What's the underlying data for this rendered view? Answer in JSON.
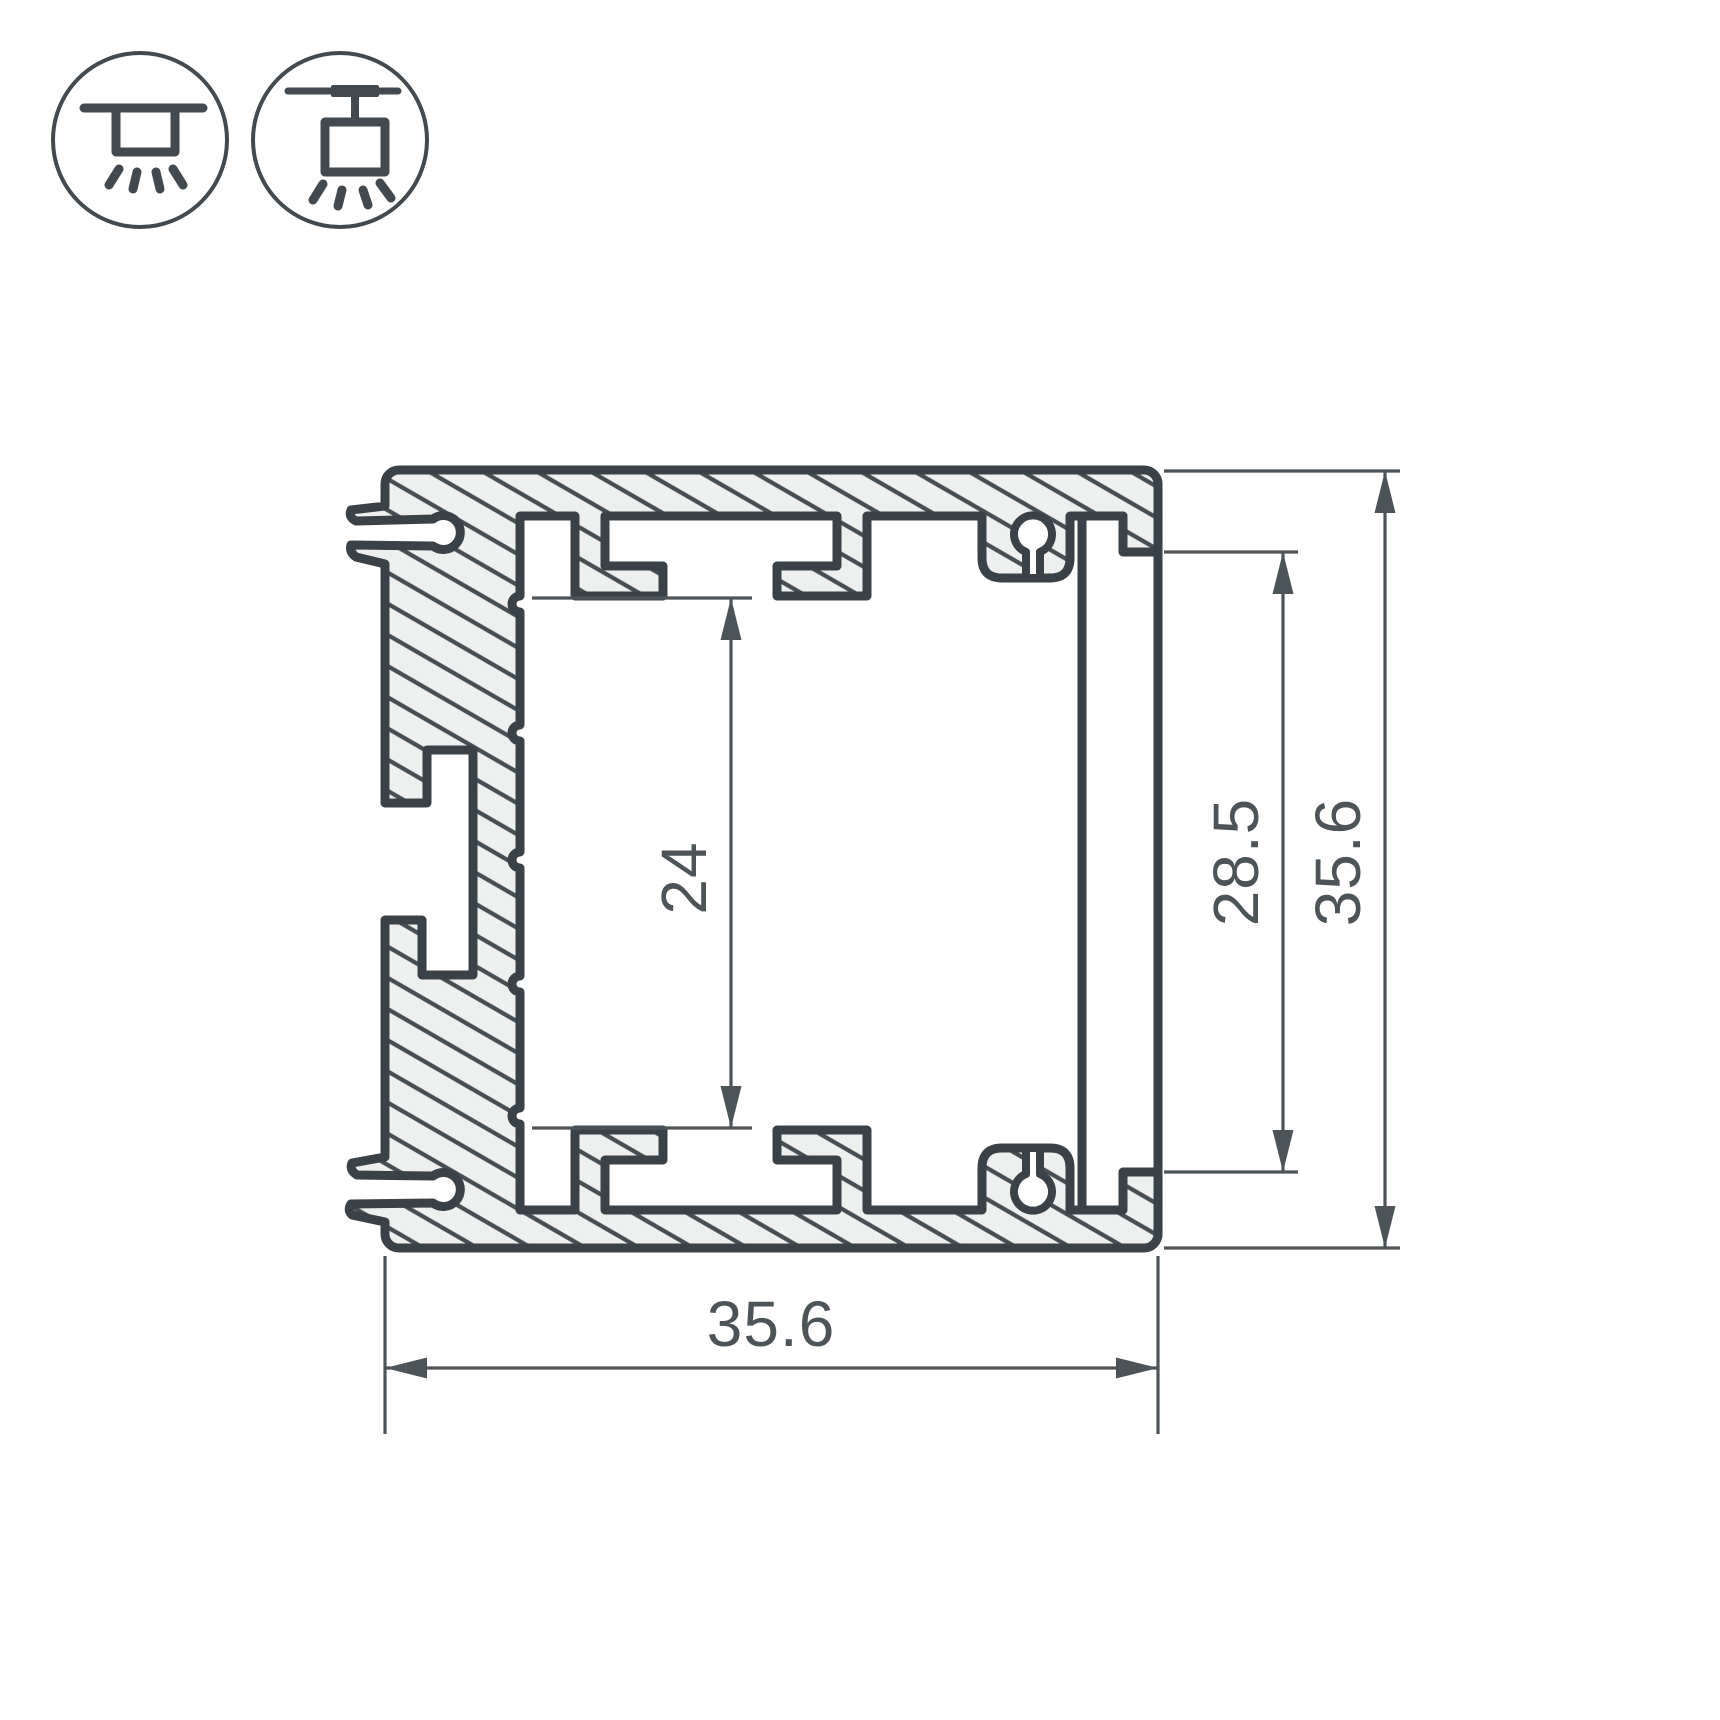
{
  "drawing": {
    "type": "technical-cross-section",
    "subject": "aluminum-led-profile"
  },
  "mount_icons": [
    {
      "name": "surface-mount-icon"
    },
    {
      "name": "suspended-mount-icon"
    }
  ],
  "dimensions": {
    "overall_width": {
      "value": "35.6",
      "orientation": "horizontal"
    },
    "overall_height": {
      "value": "35.6",
      "orientation": "vertical"
    },
    "inner_height": {
      "value": "24",
      "orientation": "vertical"
    },
    "cover_visible_height": {
      "value": "28.5",
      "orientation": "vertical"
    }
  },
  "colors": {
    "outline": "#3b4247",
    "hatch_line": "#474e52",
    "metal_fill": "#eef0f0",
    "dimension": "#4d5458",
    "background": "#ffffff"
  }
}
